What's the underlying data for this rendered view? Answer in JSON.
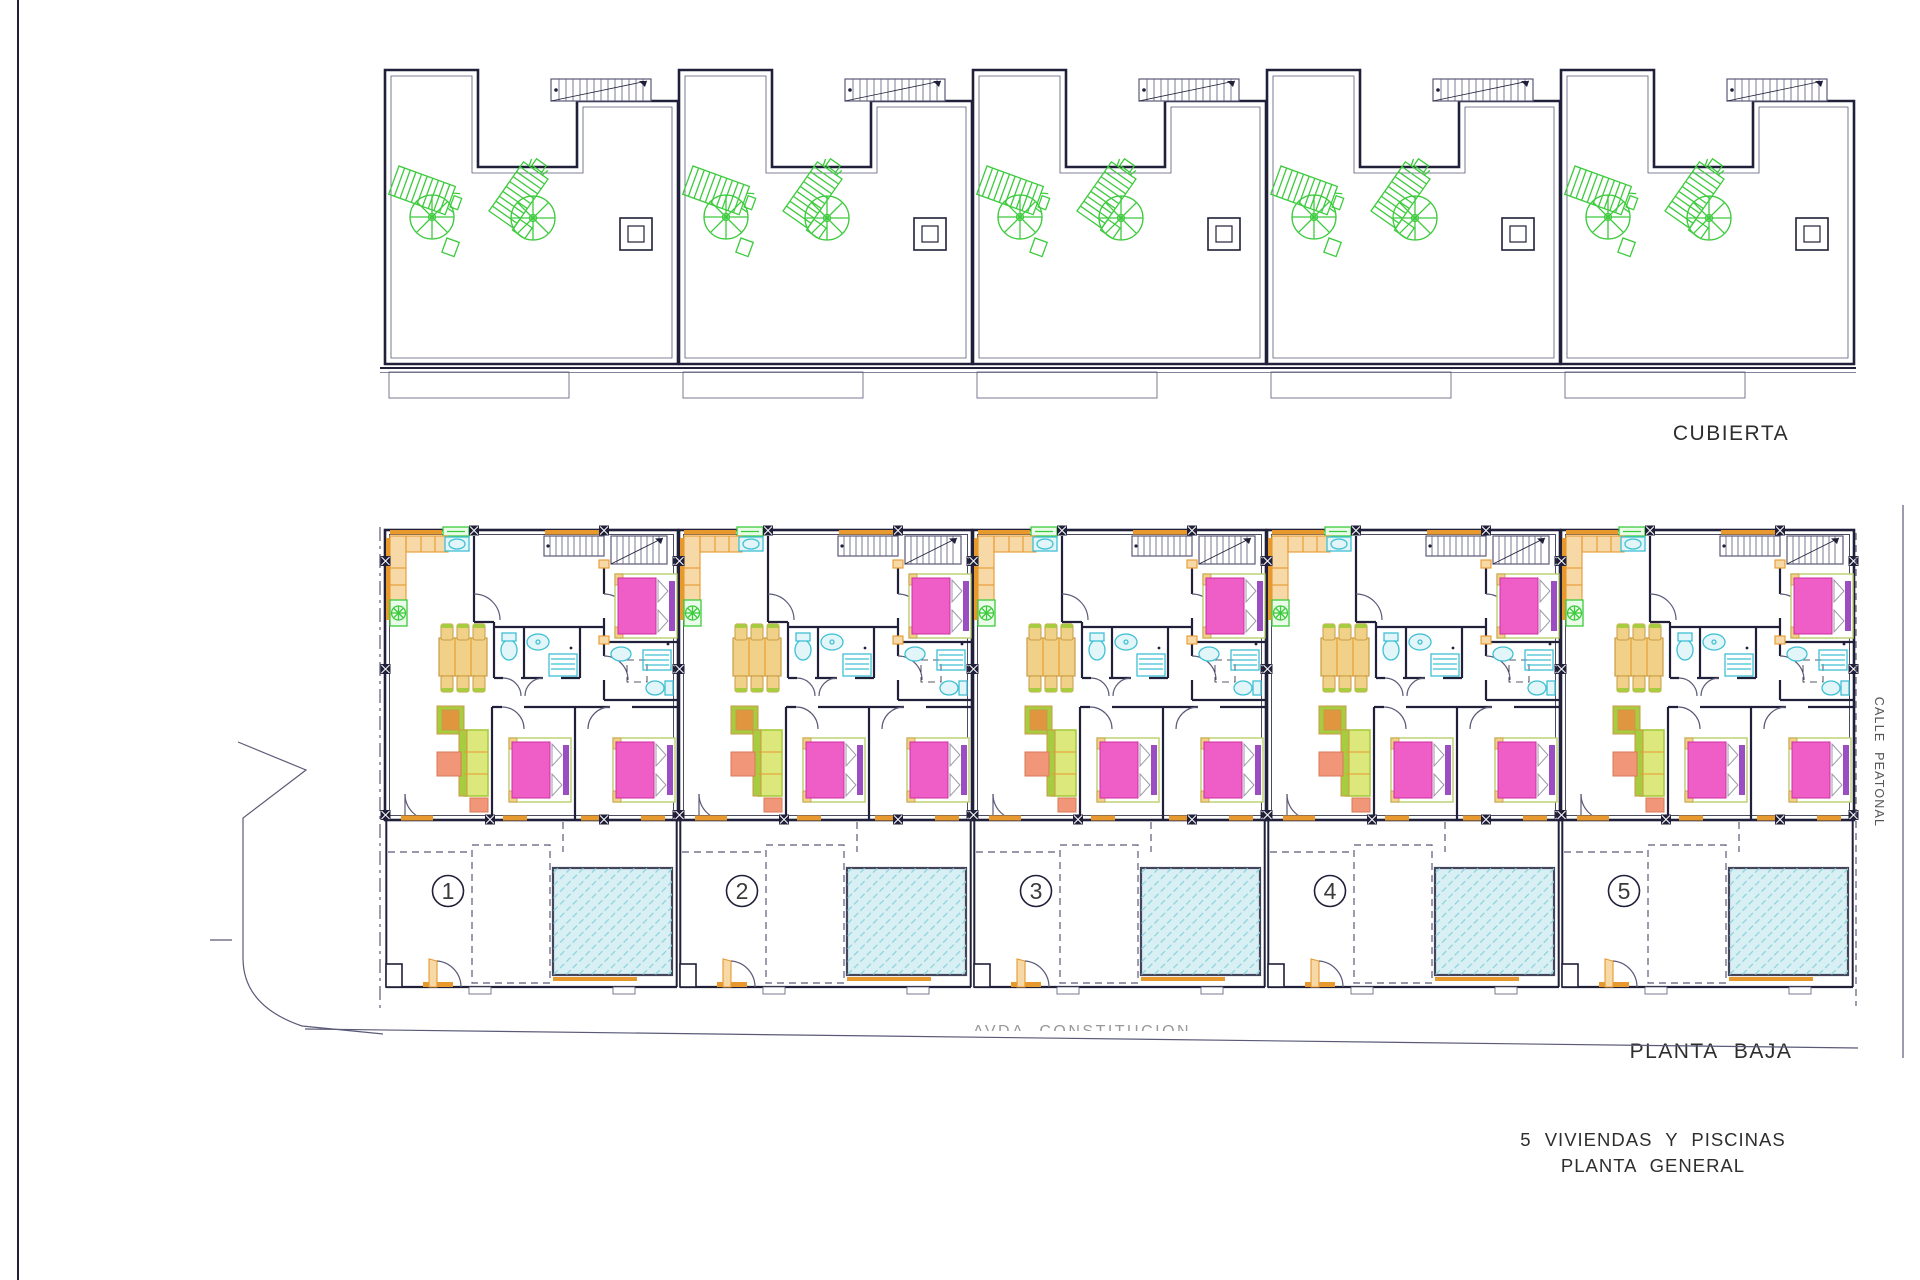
{
  "document": {
    "sheet_title_line1": "5 VIVIENDAS Y PISCINAS",
    "sheet_title_line2": "PLANTA GENERAL"
  },
  "sections": {
    "roof": {
      "label": "CUBIERTA",
      "unit_count": 5
    },
    "ground": {
      "label": "PLANTA BAJA",
      "unit_count": 5
    }
  },
  "streets": {
    "east_vertical": "CALLE PEATONAL",
    "south_clipped": "AVDA CONSTITUCION"
  },
  "units": [
    {
      "number": "1"
    },
    {
      "number": "2"
    },
    {
      "number": "3"
    },
    {
      "number": "4"
    },
    {
      "number": "5"
    }
  ],
  "icons": {
    "parasol": "parasol-icon",
    "sun_lounger": "sun-lounger-icon",
    "double_bed": "double-bed-icon",
    "stairs": "stairs-icon",
    "pool": "swimming-pool",
    "door": "door-swing-icon"
  },
  "colors": {
    "line_dark": "#20203a",
    "line_blue": "#5a5a78",
    "wall_orange": "#e8992e",
    "wall_orange_light": "#f7d9a8",
    "furniture_pink": "#ee5ec6",
    "pink_dark": "#cc2fa0",
    "pillow_purple": "#9a4ec2",
    "bath_cyan": "#3fc0d4",
    "cyan_light": "#e2f6fa",
    "garden_green": "#3ccb3c",
    "sofa_green": "#a8cc3f",
    "sofa_light": "#dce77c",
    "table_yellow": "#f1d187",
    "yellow_dark": "#c99a45",
    "armchair_orange": "#e0953f",
    "salmon": "#f2967a",
    "pool_fill": "#d8f0f4",
    "pool_hatch": "#8ed2dc",
    "pool_border": "#44445a",
    "text_dark": "#2e2e2e",
    "text_muted": "#999999"
  }
}
